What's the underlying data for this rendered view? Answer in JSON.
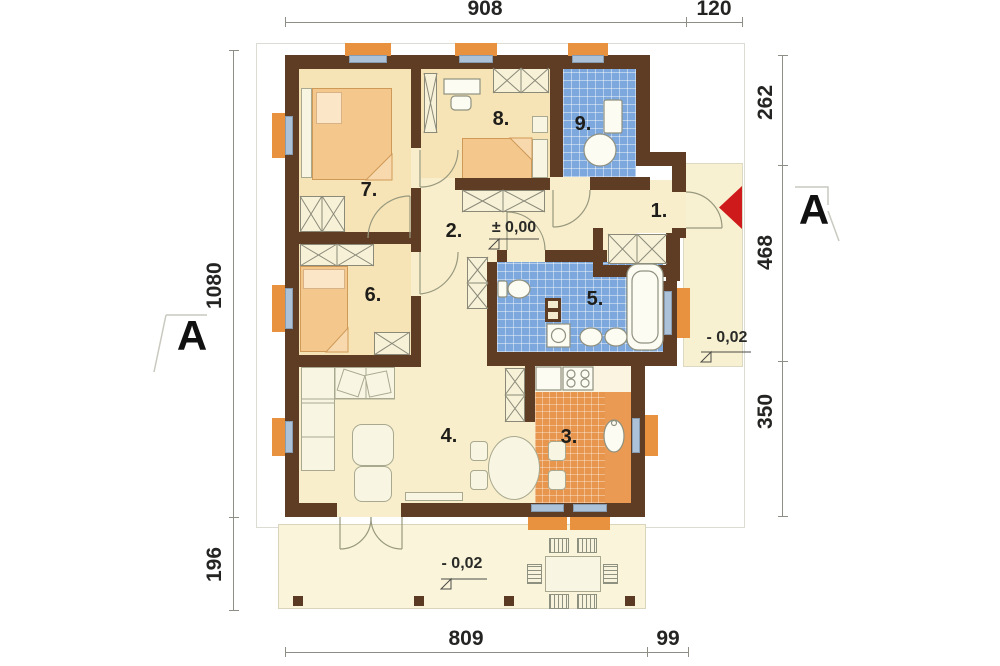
{
  "drawing": "single-storey house floor plan",
  "dims": {
    "top": [
      "908",
      "120"
    ],
    "bottom": [
      "809",
      "99"
    ],
    "left": [
      "1080",
      "196"
    ],
    "right": [
      "262",
      "468",
      "350"
    ]
  },
  "rooms": {
    "r1": "1.",
    "r2": "2.",
    "r3": "3.",
    "r4": "4.",
    "r5": "5.",
    "r6": "6.",
    "r7": "7.",
    "r8": "8.",
    "r9": "9."
  },
  "levels": {
    "main": "± 0,00",
    "porch": "- 0,02",
    "terrace": "- 0,02"
  },
  "section": {
    "left": "A",
    "right": "A"
  },
  "colors": {
    "wall": "#5f3c24",
    "window_sill": "#e8913f",
    "window_glass": "#abc2d8",
    "bath_tile": "#7da8dd",
    "kitchen_tile": "#e8964d",
    "floor": "#f9eecb",
    "bedroom_floor": "#f7e4b6",
    "terrace": "#faf5da",
    "entrance_arrow": "#ce1a1a"
  }
}
